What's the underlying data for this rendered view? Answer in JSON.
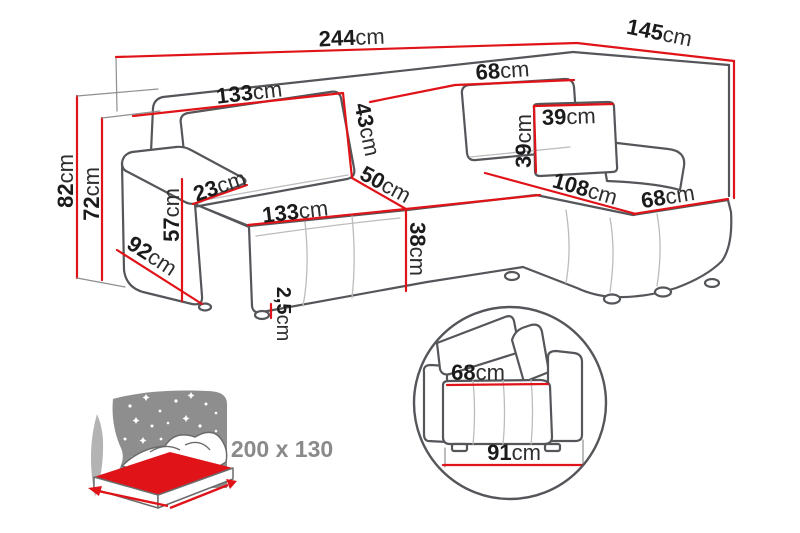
{
  "diagram_type": "corner-sofa dimension drawing",
  "unit": "cm",
  "dims": {
    "total_width": {
      "num": "244",
      "unit": "cm"
    },
    "total_depth": {
      "num": "145",
      "unit": "cm"
    },
    "backrest_width": {
      "num": "133",
      "unit": "cm"
    },
    "chaise_back_width": {
      "num": "68",
      "unit": "cm"
    },
    "back_cushion_height": {
      "num": "43",
      "unit": "cm"
    },
    "seat_depth": {
      "num": "50",
      "unit": "cm"
    },
    "seat_width": {
      "num": "133",
      "unit": "cm"
    },
    "seat_height": {
      "num": "38",
      "unit": "cm"
    },
    "leg_height": {
      "num": "2,5",
      "unit": "cm"
    },
    "armrest_width": {
      "num": "23",
      "unit": "cm"
    },
    "armrest_height": {
      "num": "57",
      "unit": "cm"
    },
    "armrest_depth": {
      "num": "92",
      "unit": "cm"
    },
    "total_height": {
      "num": "82",
      "unit": "cm"
    },
    "backrest_height": {
      "num": "72",
      "unit": "cm"
    },
    "pillow_width": {
      "num": "39",
      "unit": "cm"
    },
    "pillow_height": {
      "num": "39",
      "unit": "cm"
    },
    "chaise_length": {
      "num": "108",
      "unit": "cm"
    },
    "chaise_width": {
      "num": "68",
      "unit": "cm"
    },
    "detail_seat_depth": {
      "num": "68",
      "unit": "cm"
    },
    "detail_base_depth": {
      "num": "91",
      "unit": "cm"
    }
  },
  "sleeping_area": {
    "label": "200 x 130"
  },
  "colors": {
    "dimension_red": "#e01418",
    "outline_gray": "#54565a",
    "seam_gray": "#bcbcbc",
    "text_dark": "#1b1b1b",
    "muted_gray": "#8a8a8a",
    "sky_gray": "#8e8e8e",
    "crescent_gray": "#b3b3b3"
  }
}
